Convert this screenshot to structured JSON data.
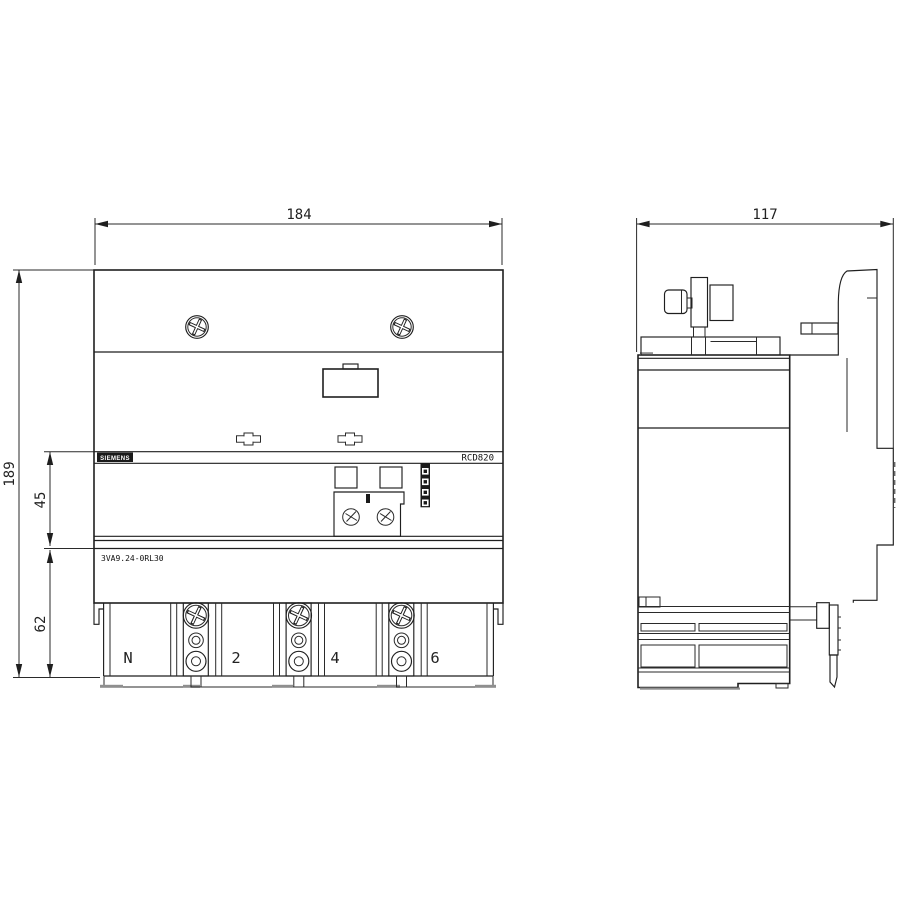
{
  "drawing_title": "RCD820 residual current device dimension drawing",
  "dims": {
    "front_width": "184",
    "front_height": "189",
    "upper_section": "45",
    "lower_section": "62",
    "side_depth": "117"
  },
  "labels": {
    "brand": "SIEMENS",
    "model": "RCD820",
    "part_number": "3VA9.24-0RL30"
  },
  "terminals": [
    "N",
    "2",
    "4",
    "6"
  ],
  "colors": {
    "line": "#1f1f1f",
    "gray_accent": "#8f8f8f",
    "background": "#ffffff",
    "badge_bg": "#111111"
  }
}
